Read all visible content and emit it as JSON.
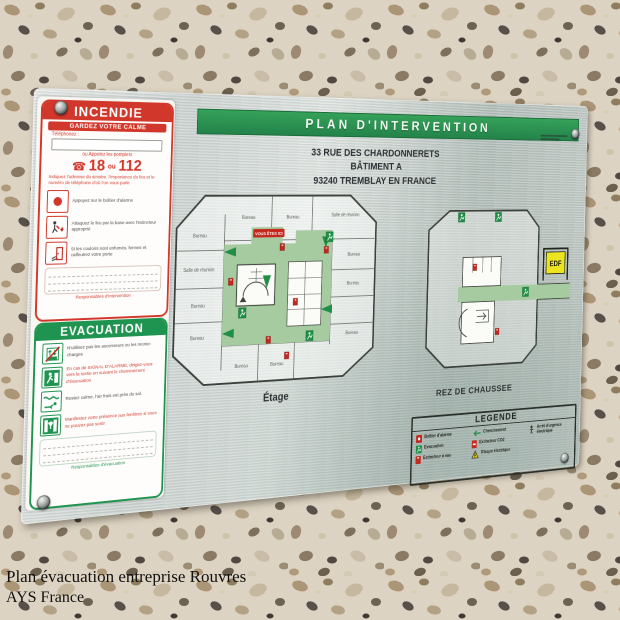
{
  "photo": {
    "caption_line1": "Plan évacuation entreprise Rouvres",
    "caption_line2": "AYS France"
  },
  "colors": {
    "banner_green": "#2c9653",
    "alert_red": "#d2372b",
    "evac_green": "#1f9450",
    "plan_corridor_green": "#a7cba1",
    "edf_yellow": "#ece41e",
    "plate_metal": "#c9d0cd"
  },
  "plate": {
    "title": "PLAN D'INTERVENTION",
    "address": [
      "33 RUE DES CHARDONNERETS",
      "BÂTIMENT A",
      "93240 TREMBLAY EN FRANCE"
    ],
    "incendie": {
      "title": "INCENDIE",
      "subtitle": "GARDEZ VOTRE CALME",
      "phone_label": "Téléphonez :",
      "call_label": "ou Appelez les pompiers",
      "n1": "18",
      "ou": "ou",
      "n2": "112",
      "notice": "Indiquez l'adresse du sinistre, l'importance du feu et le numéro de téléphone d'où l'on vous parle",
      "steps": [
        {
          "icon": "alarm-button-icon",
          "text": "Appuyez sur le boîtier d'alarme"
        },
        {
          "icon": "extinguisher-user-icon",
          "text": "Attaquez le feu par la base avec l'extincteur approprié"
        },
        {
          "icon": "door-icon",
          "text": "Si les couloirs sont enfumés, fermez et calfeutrez votre porte"
        }
      ],
      "footer": "Responsables d'intervention"
    },
    "evacuation": {
      "title": "EVACUATION",
      "steps": [
        {
          "icon": "no-elevator-icon",
          "text": "N'utilisez pas les ascenseurs ou les monte-charges"
        },
        {
          "icon": "exit-man-icon",
          "text": "En cas de SIGNAL D'ALARME, dirigez-vous vers la sortie en suivant le cheminement d'évacuation"
        },
        {
          "icon": "crawl-icon",
          "text": "Restez calme, l'air frais est près du sol."
        },
        {
          "icon": "window-icon",
          "text": "Manifestez votre présence aux fenêtres si vous ne pouvez pas sortir"
        }
      ],
      "footer": "Responsables d'évacuation"
    },
    "floor1": {
      "label": "Étage",
      "you_are_here": "VOUS ÊTES ICI",
      "rooms": [
        "Bureau",
        "Bureau",
        "Salle de réunion",
        "Bureau",
        "Salle de réunion",
        "Bureau",
        "Bureau",
        "Bureau",
        "Bureau",
        "Bureau",
        "Bureau",
        "Bureau"
      ]
    },
    "floor0": {
      "label": "REZ DE CHAUSSEE",
      "edf_label": "EDF"
    },
    "legend": {
      "title": "LEGENDE",
      "alarm": "Boîtier d'alarme",
      "chem": "Cheminement",
      "arret": "Arrêt d'urgence électrique",
      "evac": "Evacuation",
      "co2": "Extincteur CO2",
      "eau": "Extincteur à eau",
      "risque": "Risque électrique"
    }
  }
}
